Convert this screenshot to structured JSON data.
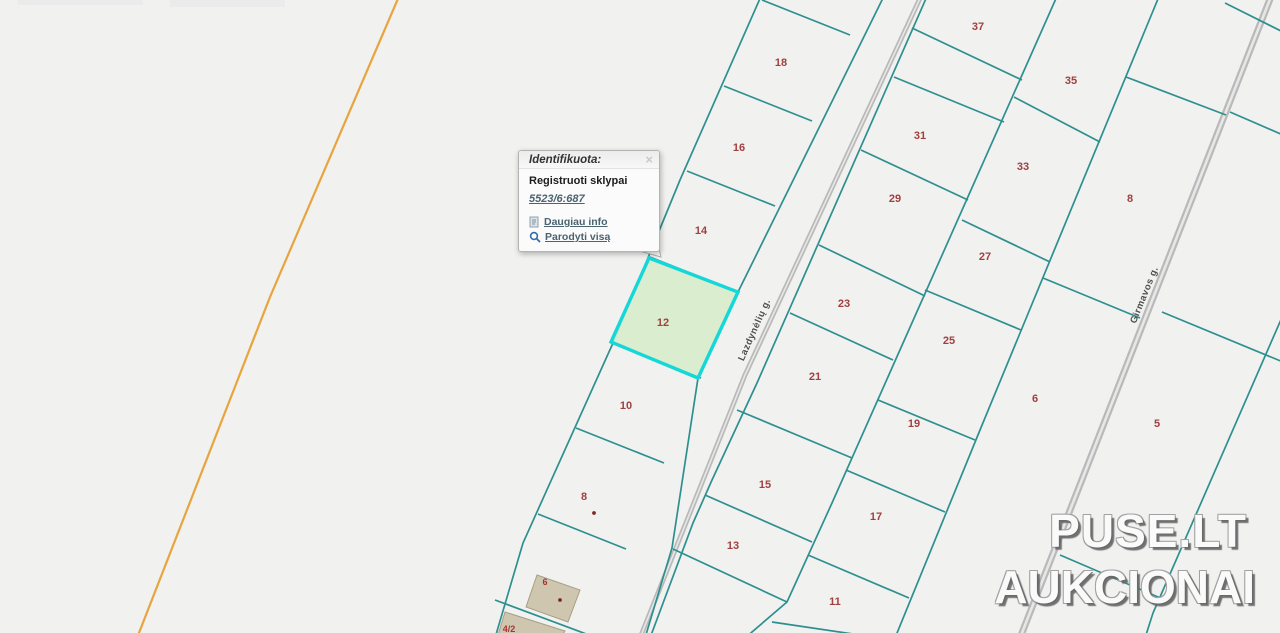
{
  "popup": {
    "title": "Identifikuota:",
    "close_label": "×",
    "subtitle": "Registruoti sklypai",
    "cadastral_number": "5523/6:687",
    "links": [
      {
        "icon": "document-icon",
        "label": "Daugiau info"
      },
      {
        "icon": "zoom-icon",
        "label": "Parodyti visą"
      }
    ]
  },
  "watermark": {
    "line1": "PUSE.LT",
    "line2": "AUKCIONAI"
  },
  "map": {
    "colors": {
      "background": "#f1f1f0",
      "parcel_line": "#2e8f8f",
      "highlight_stroke": "#15d7d7",
      "highlight_fill": "#d8eccb",
      "road": "#b9b9b9",
      "road_center": "#e7e7e7",
      "parcel_label": "#a04040",
      "street_label": "#4f4f4f",
      "boundary_orange": "#e8a43e",
      "building_fill": "#cfc6b0",
      "building_stroke": "#a79e86",
      "marker": "#7e2a23",
      "link": "#4a6470"
    },
    "highlighted_parcel": {
      "id": "12",
      "label_x": 663,
      "label_y": 326
    },
    "streets": [
      {
        "name": "Lazdynėlių g.",
        "x": 757,
        "y": 331,
        "angle": -66
      },
      {
        "name": "Girmavos g.",
        "x": 1147,
        "y": 296,
        "angle": -68
      }
    ],
    "parcel_labels": [
      {
        "text": "37",
        "x": 978,
        "y": 30
      },
      {
        "text": "35",
        "x": 1071,
        "y": 84
      },
      {
        "text": "31",
        "x": 920,
        "y": 139
      },
      {
        "text": "33",
        "x": 1023,
        "y": 170
      },
      {
        "text": "29",
        "x": 895,
        "y": 202
      },
      {
        "text": "8",
        "x": 1130,
        "y": 202
      },
      {
        "text": "27",
        "x": 985,
        "y": 260
      },
      {
        "text": "23",
        "x": 844,
        "y": 307
      },
      {
        "text": "25",
        "x": 949,
        "y": 344
      },
      {
        "text": "21",
        "x": 815,
        "y": 380
      },
      {
        "text": "6",
        "x": 1035,
        "y": 402
      },
      {
        "text": "19",
        "x": 914,
        "y": 427
      },
      {
        "text": "5",
        "x": 1157,
        "y": 427
      },
      {
        "text": "15",
        "x": 765,
        "y": 488
      },
      {
        "text": "17",
        "x": 876,
        "y": 520
      },
      {
        "text": "13",
        "x": 733,
        "y": 549
      },
      {
        "text": "11",
        "x": 835,
        "y": 605
      },
      {
        "text": "18",
        "x": 781,
        "y": 66
      },
      {
        "text": "16",
        "x": 739,
        "y": 151
      },
      {
        "text": "14",
        "x": 701,
        "y": 234
      },
      {
        "text": "10",
        "x": 626,
        "y": 409
      },
      {
        "text": "8",
        "x": 584,
        "y": 500
      }
    ],
    "building_labels": [
      {
        "text": "4/2",
        "x": 509,
        "y": 632,
        "cls": "bldg-num"
      },
      {
        "text": "6",
        "x": 545,
        "y": 585,
        "cls": "bldg-num"
      }
    ]
  }
}
